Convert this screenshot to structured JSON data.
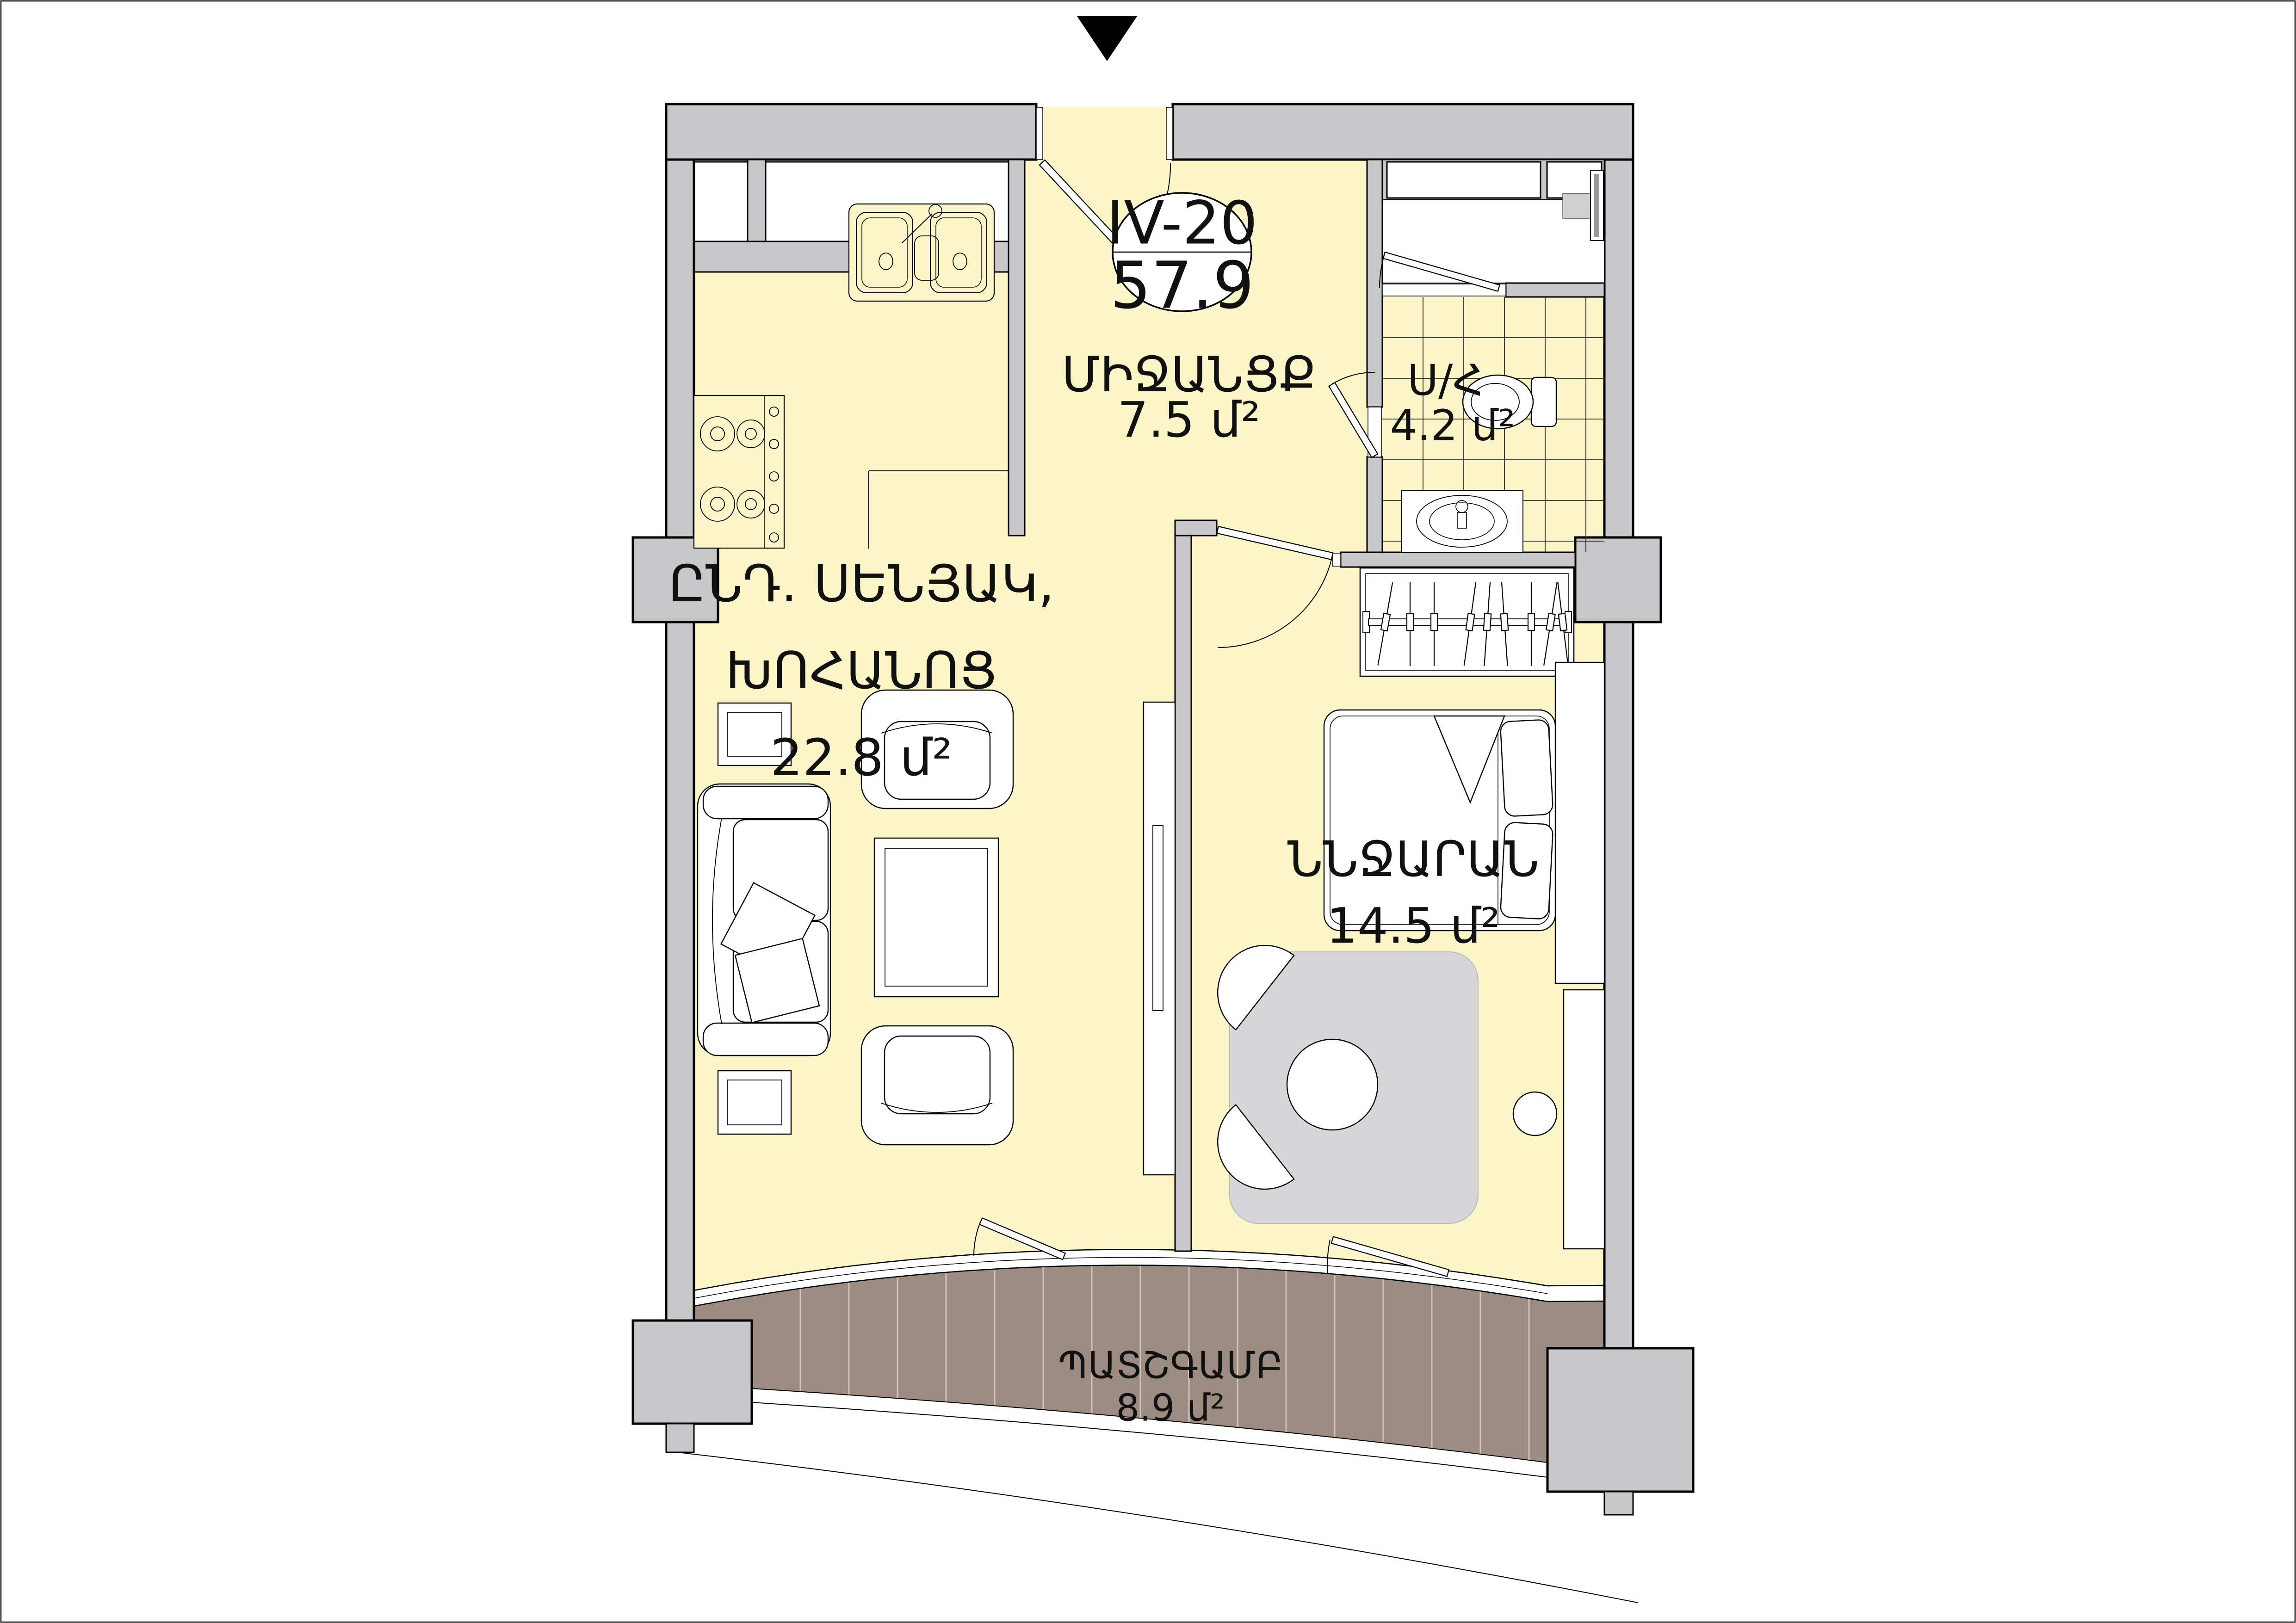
{
  "unit_label": {
    "code": "IV-20",
    "total_area": "57.9"
  },
  "rooms": [
    {
      "id": "hallway",
      "name": "ՄԻՋԱՆՑՔ",
      "area": "7.5 մ²"
    },
    {
      "id": "bathroom",
      "name": "Ս/Հ",
      "area": "4.2 մ²"
    },
    {
      "id": "living_kitchen",
      "name_line1": "ԸՆԴ. ՍԵՆՅԱԿ,",
      "name_line2": "ԽՈՀԱՆՈՑ",
      "area": "22.8 մ²"
    },
    {
      "id": "bedroom",
      "name": "ՆՆՋԱՐԱՆ",
      "area": "14.5 մ²"
    },
    {
      "id": "balcony",
      "name": "ՊԱՏՇԳԱՄԲ",
      "area": "8.9 մ²"
    }
  ],
  "colors": {
    "floor": "#fbf5c8",
    "wall": "#c7c7c9",
    "balcony_deck": "#9c8b81",
    "rug": "#d6d6d8",
    "line": "#000000"
  }
}
